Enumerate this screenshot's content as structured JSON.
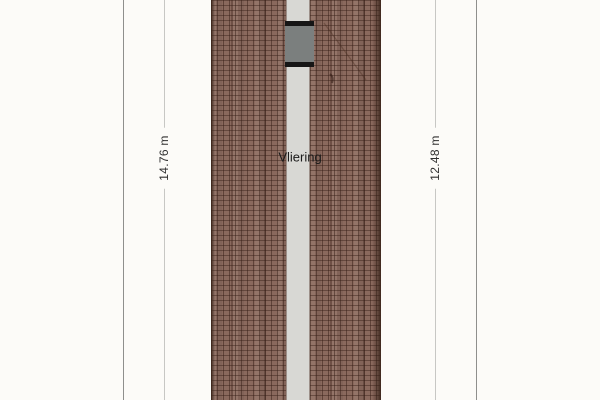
{
  "plan": {
    "room_label": "Vliering",
    "dimensions": {
      "left": {
        "label": "14.76 m"
      },
      "right": {
        "label": "12.48 m"
      }
    }
  },
  "colors": {
    "background": "#fcfbf8",
    "roof_tile_base": "#8a695d",
    "roof_tile_line": "#361e16",
    "roof_edge_dark": "#3c261c",
    "corridor_gray": "#d8d8d4",
    "skylight_glass": "#7b7f7e",
    "skylight_frame": "#161616",
    "dimension_line": "#c7c7c4",
    "boundary_line": "#8f8f8d",
    "label_text": "#2f2f2f"
  }
}
